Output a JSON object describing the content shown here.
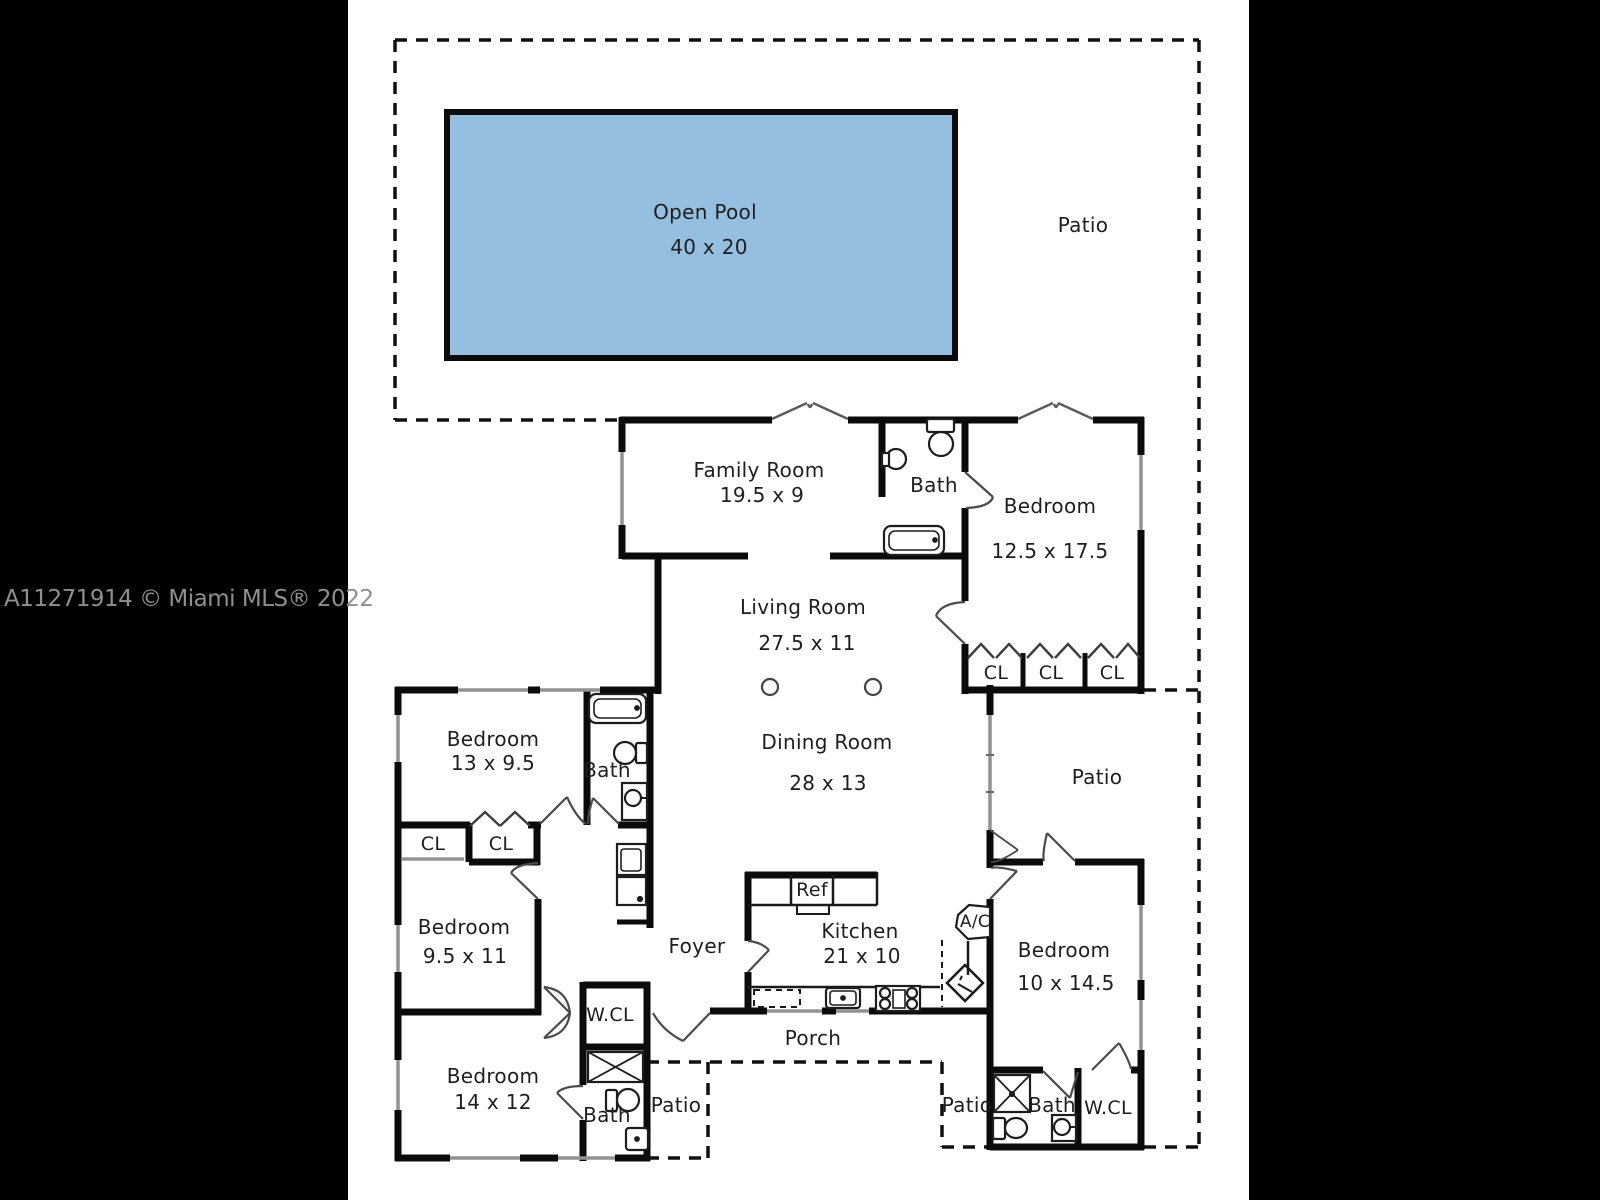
{
  "watermark": "A11271914 © Miami MLS® 2022",
  "colors": {
    "pool_fill": "#95bfe1",
    "wall": "#0b0b0b",
    "window": "#929292",
    "background": "#ffffff",
    "side_band": "#000000",
    "watermark_text": "#8f8f8f"
  },
  "labels": {
    "pool_title": "Open Pool",
    "pool_dims": "40 x 20",
    "patio_top": "Patio",
    "family_room": "Family Room",
    "family_room_dims": "19.5 x 9",
    "bath_ne": "Bath",
    "bedroom_ne": "Bedroom",
    "bedroom_ne_dims": "12.5 x 17.5",
    "living_room": "Living Room",
    "living_room_dims": "27.5 x 11",
    "cl_ne": [
      "CL",
      "CL",
      "CL"
    ],
    "bedroom_nw": "Bedroom",
    "bedroom_nw_dims": "13 x 9.5",
    "bath_w": "Bath",
    "dining_room": "Dining Room",
    "dining_room_dims": "28 x 13",
    "patio_e": "Patio",
    "cl_w": [
      "CL",
      "CL"
    ],
    "bedroom_w": "Bedroom",
    "bedroom_w_dims": "9.5 x 11",
    "foyer": "Foyer",
    "ref": "Ref",
    "kitchen": "Kitchen",
    "kitchen_dims": "21 x 10",
    "ac": "A/C",
    "bedroom_se": "Bedroom",
    "bedroom_se_dims": "10 x 14.5",
    "wcl_sw": "W.CL",
    "bedroom_sw": "Bedroom",
    "bedroom_sw_dims": "14 x 12",
    "bath_sw": "Bath",
    "patio_sw": "Patio",
    "porch": "Porch",
    "patio_se": "Patio",
    "bath_se": "Bath",
    "wcl_se": "W.CL"
  }
}
